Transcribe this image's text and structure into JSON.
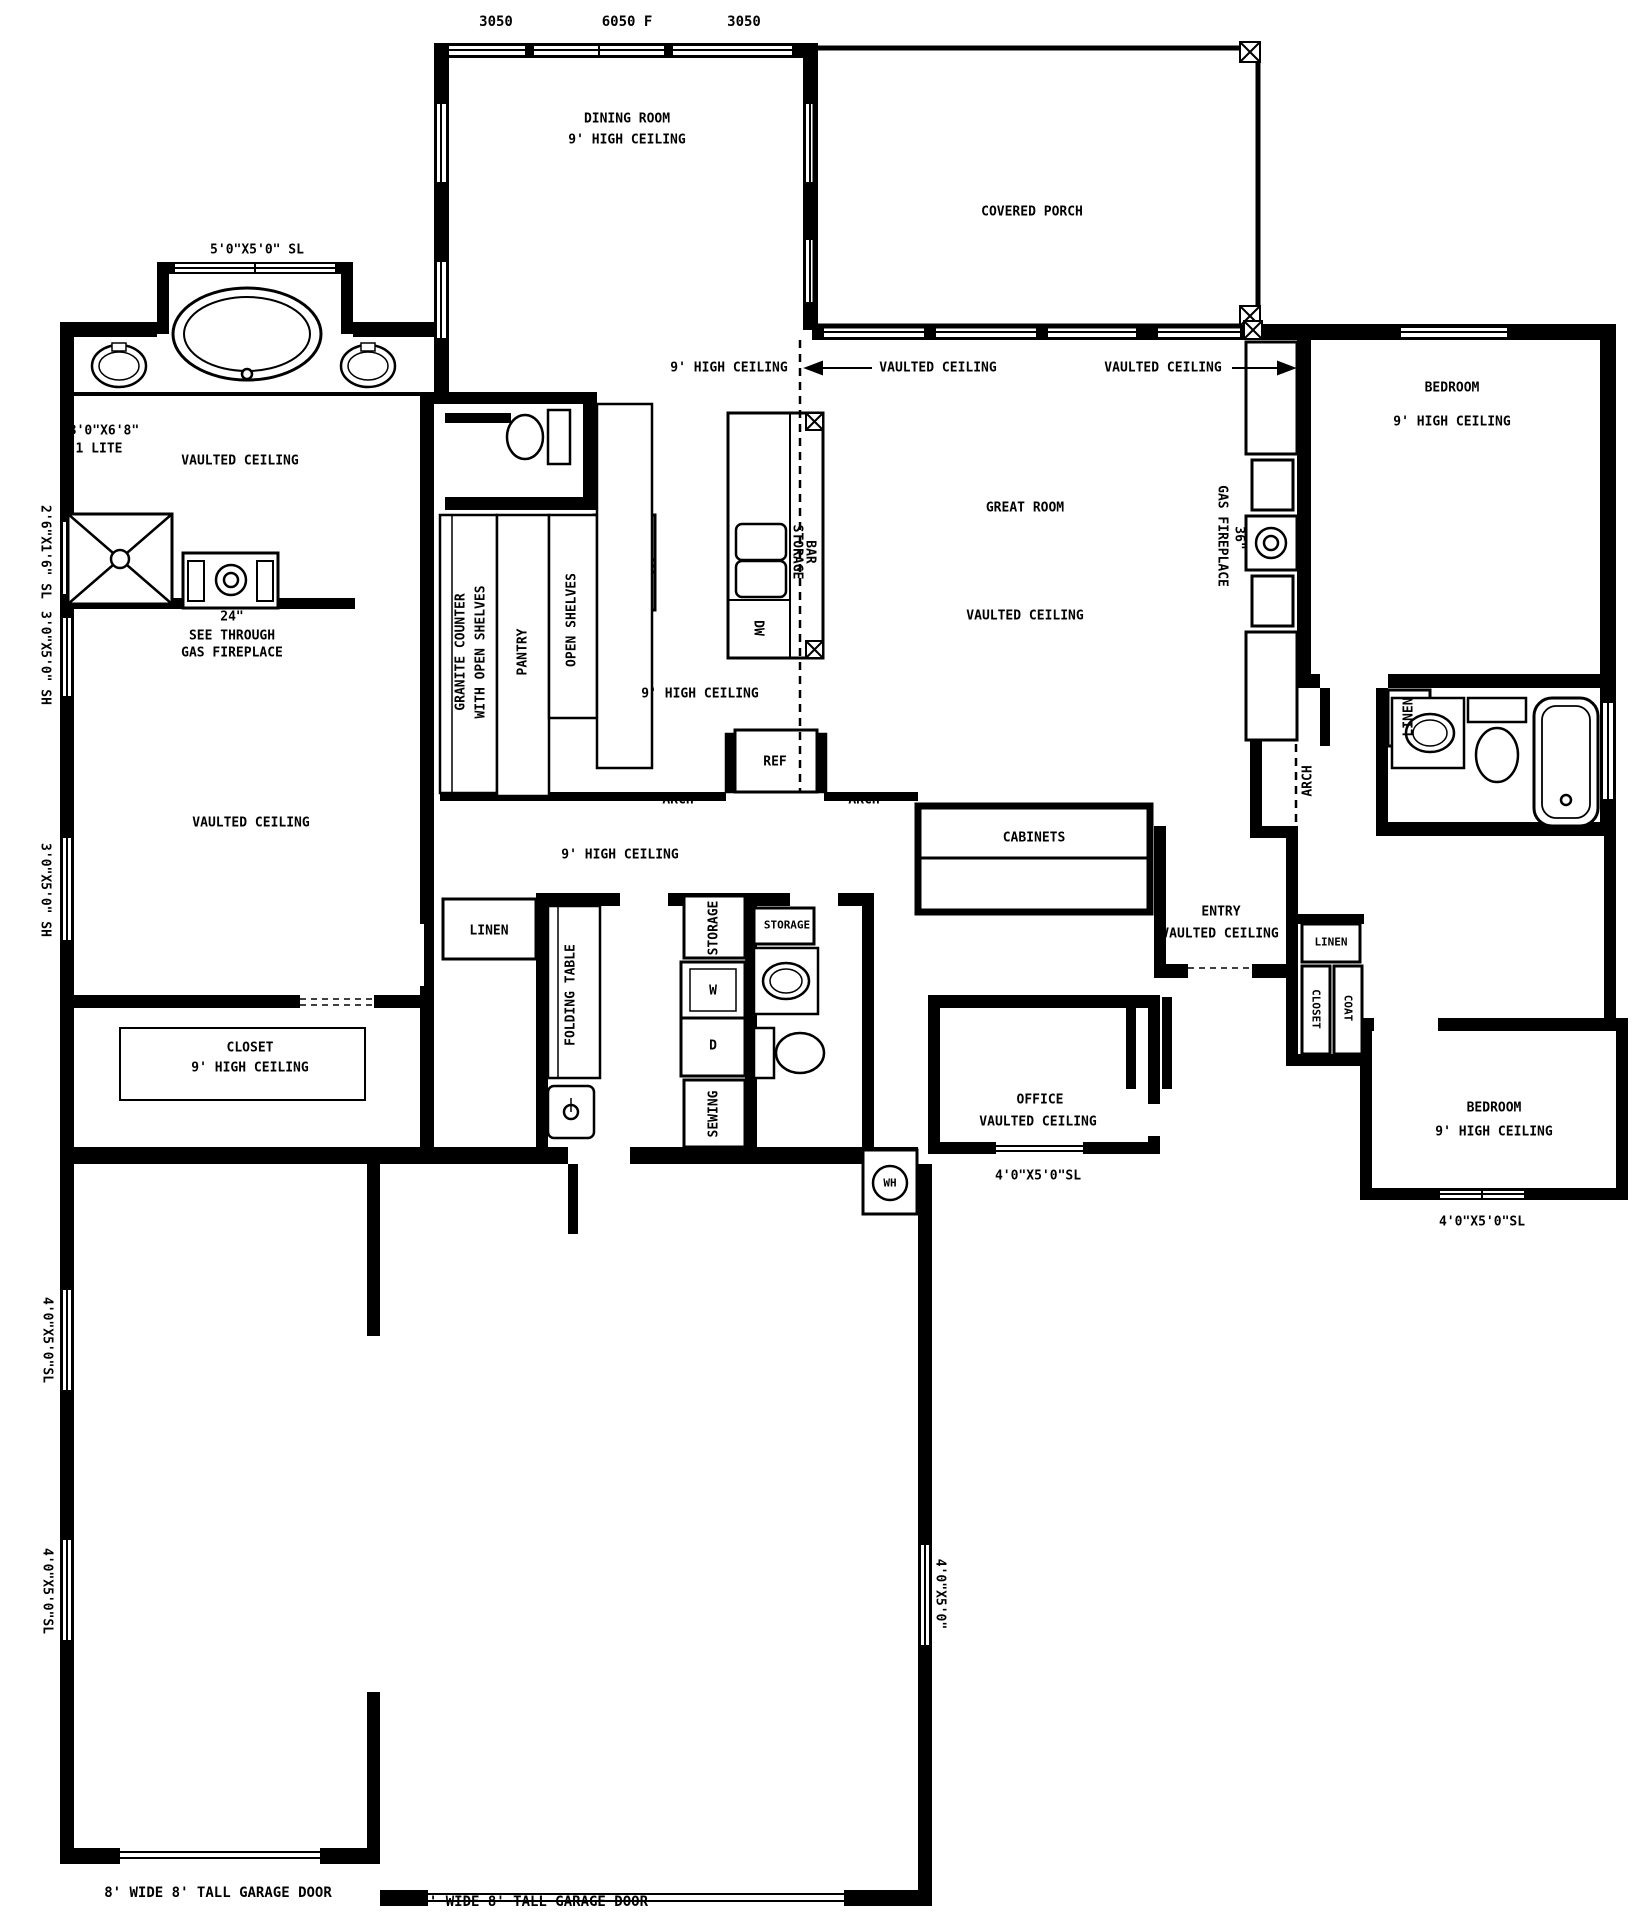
{
  "drawing": {
    "type": "residential floor plan",
    "colors": {
      "ink": "#000000",
      "paper": "#ffffff"
    }
  },
  "labels": {
    "dim_3050": "3050",
    "dim_6050f": "6050 F",
    "dining_room": "DINING ROOM",
    "high_ceiling_9": "9' HIGH CEILING",
    "covered_porch": "COVERED PORCH",
    "win_5x5_sl": "5'0\"X5'0\" SL",
    "door_3068": "3'0\"X6'8\"",
    "door_1lite": "1 LITE",
    "vaulted_ceiling": "VAULTED CEILING",
    "win_2616_sl": "2'6\"X1'6\" SL",
    "win_3050_sh": "3'0\"X5'0\" SH",
    "fp_24": "24\"",
    "see_through": "SEE THROUGH",
    "gas_fireplace": "GAS FIREPLACE",
    "granite_counter": "GRANITE COUNTER",
    "with_open_shelves": "WITH OPEN SHELVES",
    "pantry": "PANTRY",
    "open_shelves": "OPEN SHELVES",
    "storage": "STORAGE",
    "bar": "BAR",
    "dw": "DW",
    "great_room": "GREAT ROOM",
    "fp_36": "36\"",
    "bedroom": "BEDROOM",
    "linen": "LINEN",
    "ref": "REF",
    "arch": "ARCH",
    "cabinets": "CABINETS",
    "entry": "ENTRY",
    "closet": "CLOSET",
    "coat": "COAT",
    "folding_table": "FOLDING TABLE",
    "sewing": "SEWING",
    "washer": "W",
    "dryer": "D",
    "office": "OFFICE",
    "win_4050_sl": "4'0\"X5'0\"SL",
    "win_4050": "4'0\"X5'0\"",
    "wh": "WH",
    "garage_door_8": "8' WIDE 8' TALL GARAGE DOOR",
    "garage_door_18": "18' WIDE 8' TALL GARAGE DOOR"
  }
}
